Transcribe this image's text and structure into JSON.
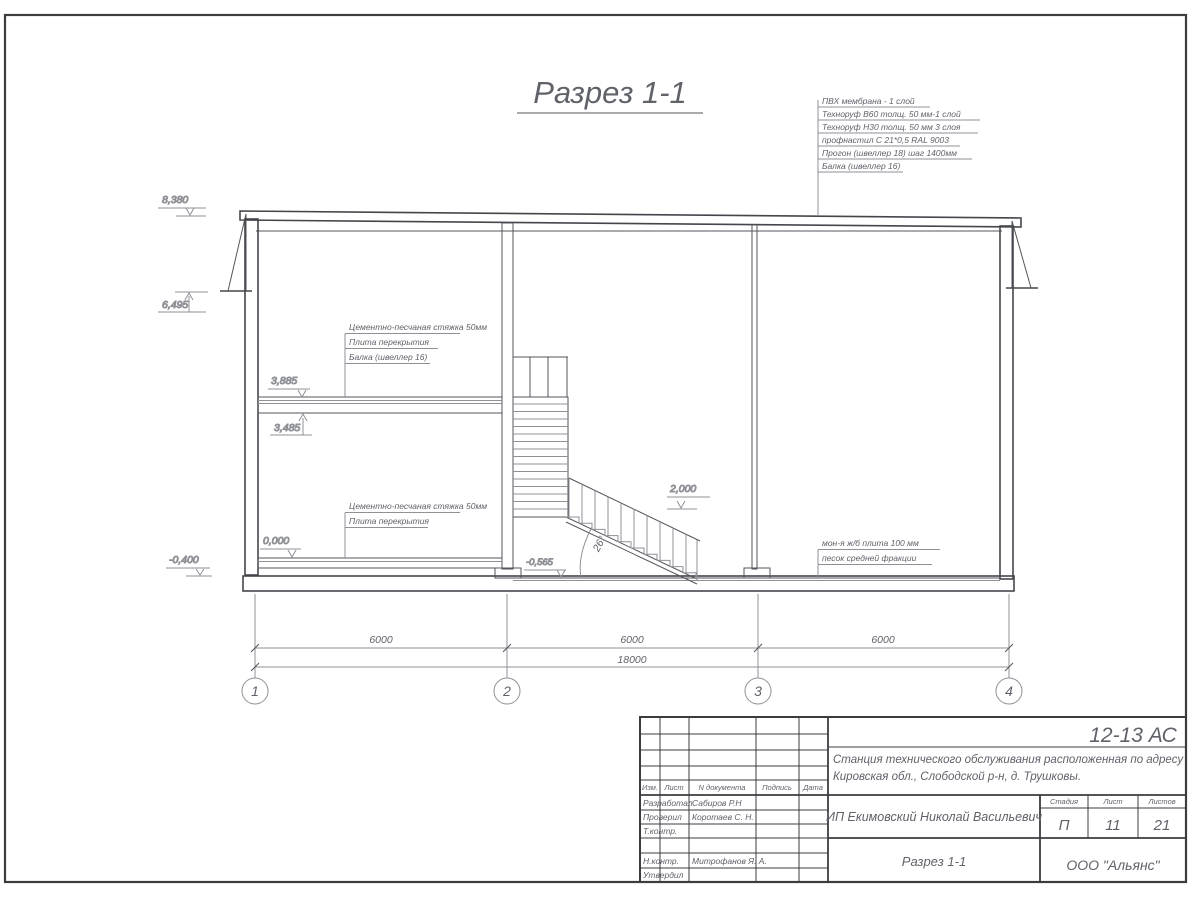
{
  "colors": {
    "line": "#44464c",
    "thin_line": "#8f9197",
    "text": "#60626a",
    "hatch_bg": "#eef0f3",
    "hatch_stroke": "#a9acb4"
  },
  "drawing_title": "Разрез 1-1",
  "roof_legend": [
    "ПВХ мембрана - 1 слой",
    "Техноруф В60 толщ. 50 мм-1 слой",
    "Техноруф Н30 толщ. 50 мм 3 слоя",
    "профнастил С 21*0,5 RAL 9003",
    "Прогон (швеллер 18) шаг 1400мм",
    "Балка (швеллер 16)"
  ],
  "floor2_legend": [
    "Цементно-песчаная стяжка 50мм",
    "Плита перекрытия",
    "Балка (швеллер 16)"
  ],
  "floor1_legend": [
    "Цементно-песчаная стяжка 50мм",
    "Плита перекрытия"
  ],
  "ground_legend": [
    "мон-я ж/б плита 100 мм",
    "песок средней фракции"
  ],
  "levels": {
    "roof": "8,380",
    "eaves": "6,495",
    "slab2_top": "3,885",
    "slab2_bottom": "3,485",
    "floor1": "0,000",
    "foundation": "-0,400",
    "landing": "2,000",
    "pit": "-0,565"
  },
  "stairs": {
    "angle": "26°"
  },
  "dimensions": {
    "bay1": "6000",
    "bay2": "6000",
    "bay3": "6000",
    "total": "18000"
  },
  "axes": {
    "a1": "1",
    "a2": "2",
    "a3": "3",
    "a4": "4"
  },
  "title_block": {
    "doc_code": "12-13 АС",
    "project_line1": "Станция технического обслуживания расположенная по адресу",
    "project_line2": "Кировская обл., Слободской р-н, д. Трушковы.",
    "client": "ИП Екимовский Николай Васильевич",
    "sheet_title": "Разрез 1-1",
    "company": "ООО \"Альянс\"",
    "stage_label": "Стадия",
    "sheet_label": "Лист",
    "sheets_label": "Листов",
    "stage": "П",
    "sheet": "11",
    "sheets": "21",
    "header": {
      "izm": "Изм.",
      "list": "Лист",
      "ndoc": "N документа",
      "podpis": "Подпись",
      "data": "Дата"
    },
    "roles": {
      "r1": "Разработал",
      "r2": "Проверил",
      "r3": "Т.контр.",
      "r4": "Н.контр.",
      "r5": "Утвердил"
    },
    "names": {
      "n1": "Сабиров Р.Н",
      "n2": "Коротаев С. Н.",
      "n4": "Митрофанов Я. А."
    }
  }
}
